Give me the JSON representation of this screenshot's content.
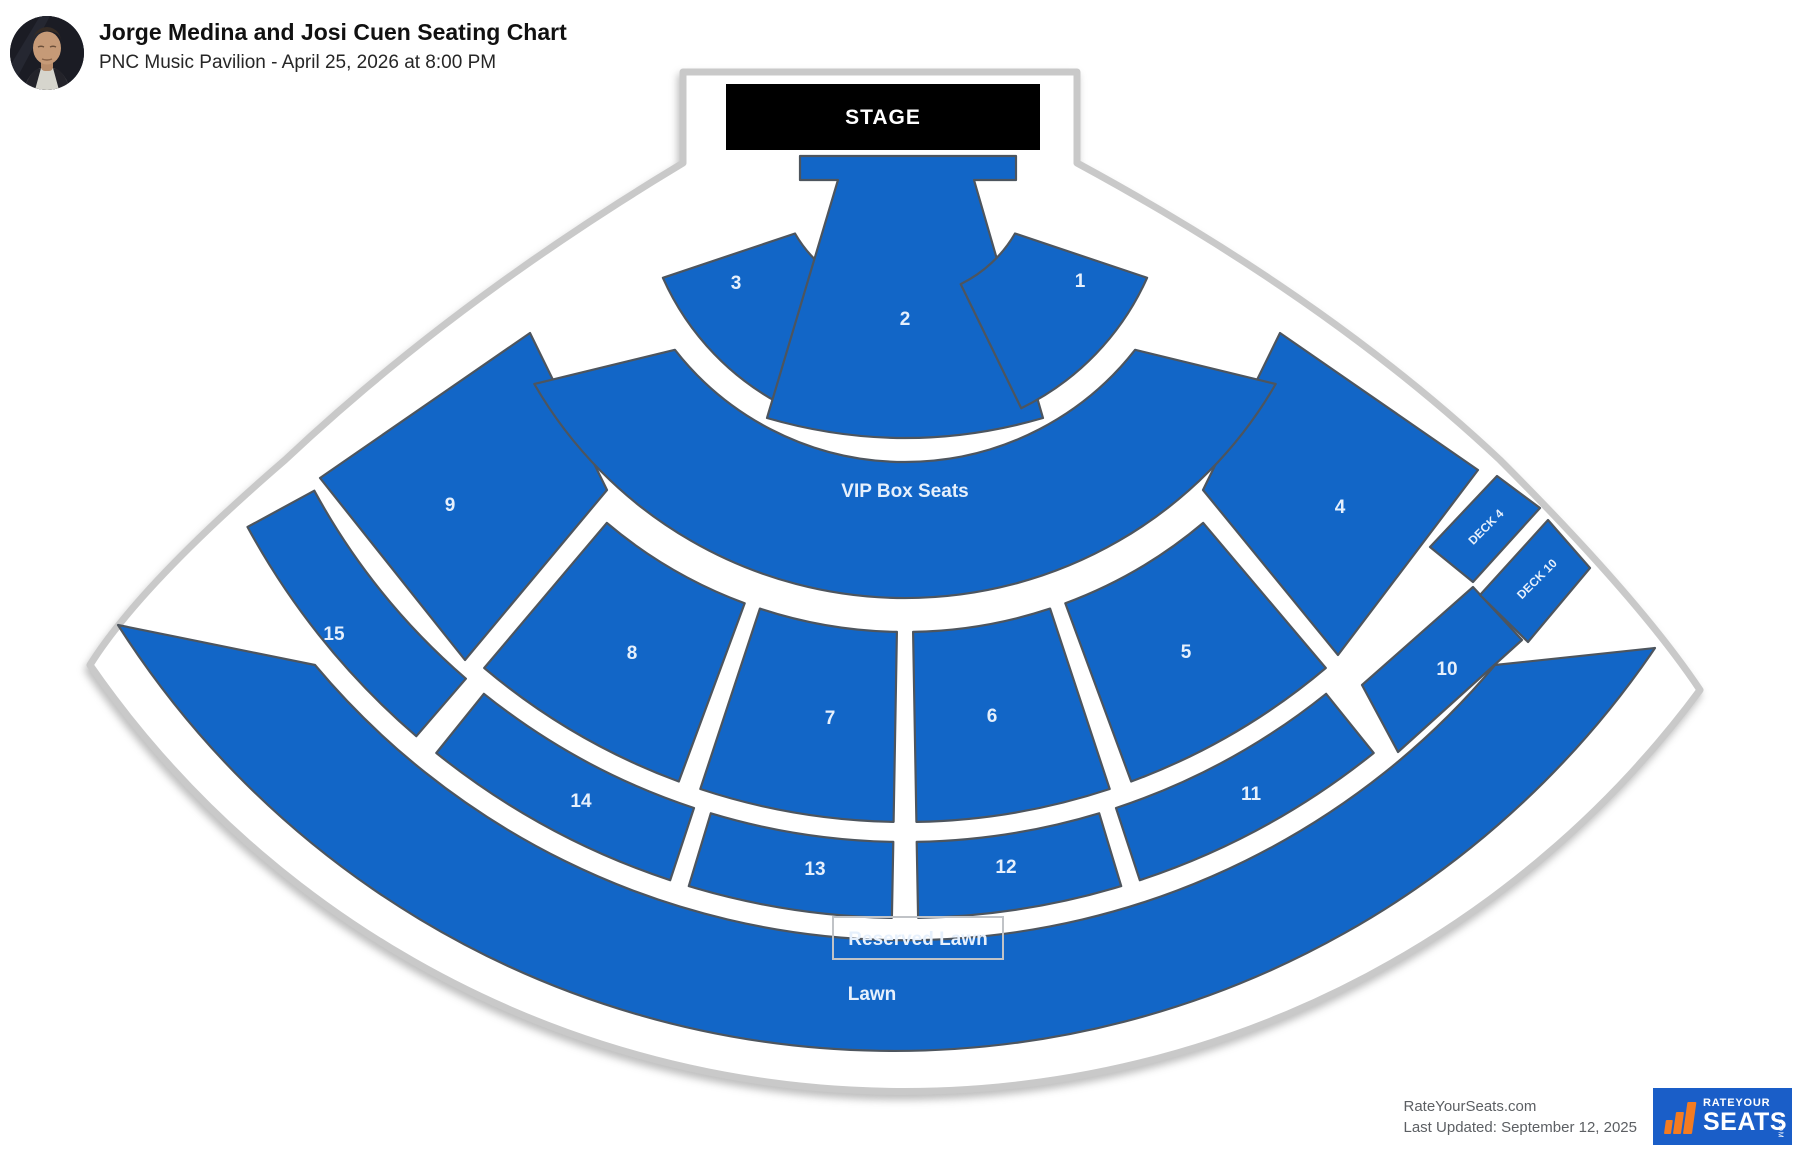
{
  "header": {
    "title": "Jorge Medina and Josi Cuen Seating Chart",
    "subtitle": "PNC Music Pavilion - April 25, 2026 at 8:00 PM"
  },
  "stage": {
    "label": "STAGE"
  },
  "sections": [
    {
      "id": "lawnsec",
      "label": "Lawn"
    },
    {
      "id": "s15",
      "label": "15"
    },
    {
      "id": "s14",
      "label": "14"
    },
    {
      "id": "s13",
      "label": "13"
    },
    {
      "id": "s12",
      "label": "12"
    },
    {
      "id": "s11",
      "label": "11"
    },
    {
      "id": "s10",
      "label": "10"
    },
    {
      "id": "deck4",
      "label": "DECK 4"
    },
    {
      "id": "deck10",
      "label": "DECK 10"
    },
    {
      "id": "s9",
      "label": "9"
    },
    {
      "id": "s8",
      "label": "8"
    },
    {
      "id": "s7",
      "label": "7"
    },
    {
      "id": "s6",
      "label": "6"
    },
    {
      "id": "s5",
      "label": "5"
    },
    {
      "id": "s4",
      "label": "4"
    },
    {
      "id": "vip",
      "label": "VIP Box Seats"
    },
    {
      "id": "s3",
      "label": "3"
    },
    {
      "id": "s2",
      "label": "2"
    },
    {
      "id": "s1",
      "label": "1"
    }
  ],
  "reserved_lawn": {
    "label": "Reserved Lawn"
  },
  "footer": {
    "site": "RateYourSeats.com",
    "updated": "Last Updated: September 12, 2025",
    "logo": {
      "top": "RATEYOUR",
      "main": "SEATS",
      "suffix": ".COM"
    }
  },
  "icons": {
    "logo_bars": "bar-chart-icon",
    "avatar": "artist-photo"
  },
  "colors": {
    "section_blue": "#1266c7",
    "section_border": "#4d555e",
    "outline_gray": "#c9c9c9",
    "logo_blue": "#1a5ec8",
    "logo_orange": "#f47b20"
  }
}
